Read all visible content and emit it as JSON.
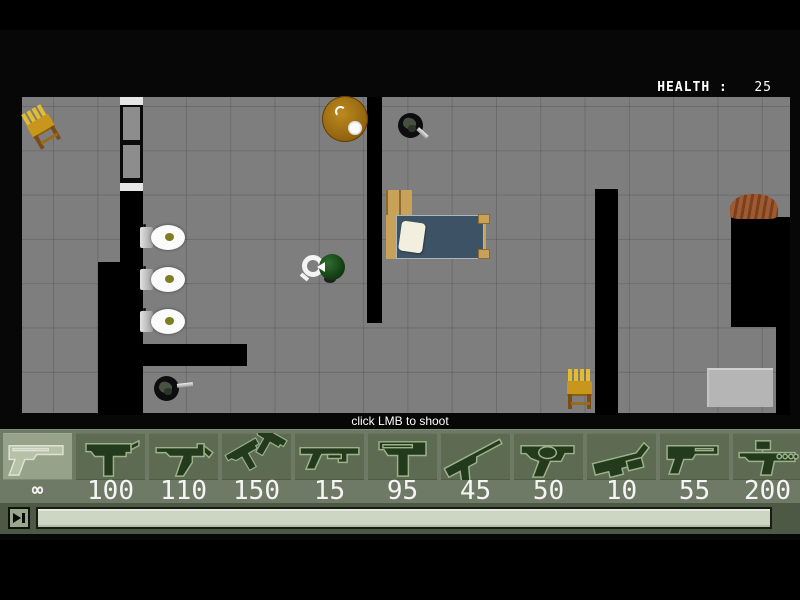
{
  "hud": {
    "health_label": "HEALTH :",
    "health_value": "25",
    "hint": "click LMB to shoot"
  },
  "weapon_bar": {
    "selected_index": 0,
    "cell_pitch": 73,
    "cell_width": 69,
    "weapons": [
      {
        "icon": "desert-eagle-icon",
        "ammo": "∞"
      },
      {
        "icon": "uzi-icon",
        "ammo": "100"
      },
      {
        "icon": "mp5-icon",
        "ammo": "110"
      },
      {
        "icon": "dual-uzi-icon",
        "ammo": "150"
      },
      {
        "icon": "shotgun-icon",
        "ammo": "15"
      },
      {
        "icon": "tec9-icon",
        "ammo": "95"
      },
      {
        "icon": "silenced-pistol-icon",
        "ammo": "45"
      },
      {
        "icon": "revolver-icon",
        "ammo": "50"
      },
      {
        "icon": "grenade-launcher-icon",
        "ammo": "10"
      },
      {
        "icon": "p99-pistol-icon",
        "ammo": "55"
      },
      {
        "icon": "scoped-rifle-icon",
        "ammo": "200"
      }
    ]
  },
  "map": {
    "floor": {
      "x": 22,
      "y": 97,
      "w": 768,
      "h": 316
    },
    "window": {
      "x": 120,
      "y": 97,
      "w": 23,
      "h": 94
    },
    "walls": [
      {
        "x": 120,
        "y": 190,
        "w": 23,
        "h": 225
      },
      {
        "x": 98,
        "y": 262,
        "w": 24,
        "h": 153
      },
      {
        "x": 143,
        "y": 344,
        "w": 104,
        "h": 22
      },
      {
        "x": 367,
        "y": 97,
        "w": 15,
        "h": 226
      },
      {
        "x": 595,
        "y": 189,
        "w": 23,
        "h": 226
      },
      {
        "x": 731,
        "y": 217,
        "w": 59,
        "h": 110
      },
      {
        "x": 776,
        "y": 327,
        "w": 14,
        "h": 88
      }
    ],
    "objects": [
      {
        "name": "wooden-chair",
        "x": 28,
        "y": 106,
        "w": 29,
        "h": 42,
        "rot": -30
      },
      {
        "name": "round-table",
        "x": 322,
        "y": 96,
        "w": 46,
        "h": 46,
        "rot": 0
      },
      {
        "name": "enemy-knife",
        "x": 397,
        "y": 112,
        "w": 32,
        "h": 32,
        "rot": 0
      },
      {
        "name": "bed",
        "x": 384,
        "y": 189,
        "w": 110,
        "h": 71,
        "rot": 0
      },
      {
        "name": "player",
        "x": 300,
        "y": 249,
        "w": 45,
        "h": 36,
        "rot": 0
      },
      {
        "name": "toilet",
        "x": 139,
        "y": 224,
        "w": 47,
        "h": 27,
        "rot": 0
      },
      {
        "name": "toilet",
        "x": 139,
        "y": 266,
        "w": 47,
        "h": 27,
        "rot": 0
      },
      {
        "name": "toilet",
        "x": 139,
        "y": 308,
        "w": 47,
        "h": 27,
        "rot": 0
      },
      {
        "name": "enemy-pistol",
        "x": 152,
        "y": 374,
        "w": 44,
        "h": 30,
        "rot": 0
      },
      {
        "name": "wooden-chair",
        "x": 566,
        "y": 369,
        "w": 29,
        "h": 42,
        "rot": 0
      },
      {
        "name": "rug",
        "x": 730,
        "y": 194,
        "w": 48,
        "h": 25,
        "rot": 0
      },
      {
        "name": "crate",
        "x": 707,
        "y": 368,
        "w": 66,
        "h": 39,
        "rot": 0
      }
    ]
  },
  "colors": {
    "floor": "#7e7e7e",
    "wall": "#000000",
    "weapon_bar_bg": "#6f7a66",
    "weapon_cell_bg": "#5e6b53",
    "weapon_cell_selected": "#97a28b",
    "ammo_text": "#f5f5f5",
    "health_text": "#ffffff",
    "seek_bar_fill": "#ccd6c3"
  }
}
